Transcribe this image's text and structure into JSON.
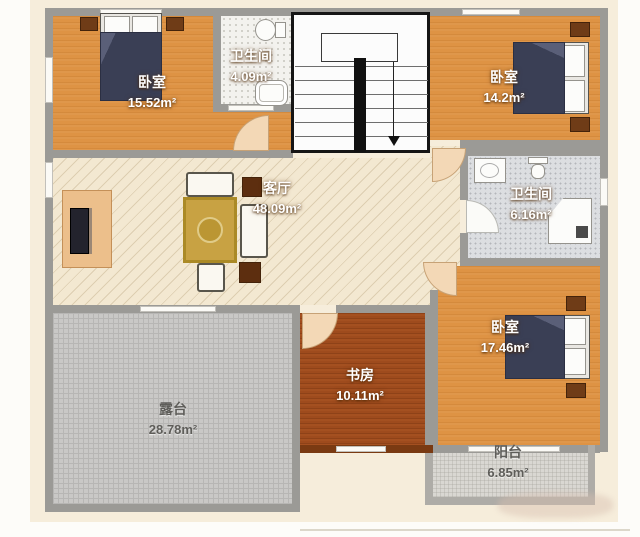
{
  "rooms": [
    {
      "id": "bedroom-top-left",
      "name": "卧室",
      "area": "15.52m²"
    },
    {
      "id": "bathroom-top",
      "name": "卫生间",
      "area": "4.09m²"
    },
    {
      "id": "bedroom-top-right",
      "name": "卧室",
      "area": "14.2m²"
    },
    {
      "id": "living-room",
      "name": "客厅",
      "area": "48.09m²"
    },
    {
      "id": "bathroom-mid",
      "name": "卫生间",
      "area": "6.16m²"
    },
    {
      "id": "bedroom-right",
      "name": "卧室",
      "area": "17.46m²"
    },
    {
      "id": "study",
      "name": "书房",
      "area": "10.11m²"
    },
    {
      "id": "terrace",
      "name": "露台",
      "area": "28.78m²"
    },
    {
      "id": "balcony",
      "name": "阳台",
      "area": "6.85m²"
    }
  ],
  "colors": {
    "wall": "#9b9a96",
    "wall_light": "#aeaca7",
    "floor_bedroom": "#de9344",
    "floor_living": "#f3e8d1",
    "living_line": "#ddceb1",
    "floor_study": "#9e4b1d",
    "floor_terrace": "#c9c8c6",
    "terrace_line": "#b7b6b4",
    "floor_balcony": "#d9d7d2",
    "floor_bath_white": "#f3f2ee",
    "floor_bath_gray": "#dcdee1",
    "cream": "#f6eddb",
    "door_peach": "#f3d8b6",
    "bed_dark": "#3a3f55",
    "wood_dark": "#6f3c17",
    "rug_gold": "#c8a243",
    "tv_stand": "#ecbf8b",
    "text_dark": "#5e5d59"
  }
}
